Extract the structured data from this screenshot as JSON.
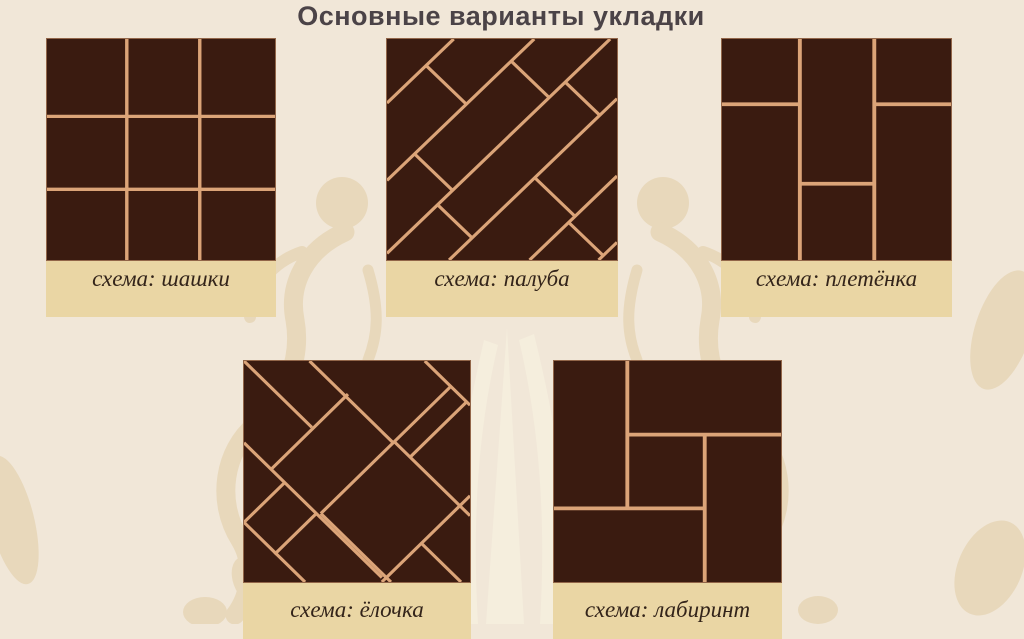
{
  "title": "Основные варианты укладки",
  "patterns": [
    {
      "id": "shashki",
      "label": "схема: шашки",
      "type": "grid"
    },
    {
      "id": "paluba",
      "label": "схема: палуба",
      "type": "deck"
    },
    {
      "id": "pletenka",
      "label": "схема: плетёнка",
      "type": "weave"
    },
    {
      "id": "yolochka",
      "label": "схема: ёлочка",
      "type": "herringbone"
    },
    {
      "id": "labirint",
      "label": "схема: лабиринт",
      "type": "pinwheel"
    }
  ],
  "colors": {
    "background": "#f1e7d8",
    "ornament_beige": "#e8d8bb",
    "ornament_light": "#f5eedd",
    "band": "#ead6a4",
    "tile": "#3a1b10",
    "grout": "#dba478",
    "title_text": "#4b4347",
    "label_text": "#33241a"
  }
}
